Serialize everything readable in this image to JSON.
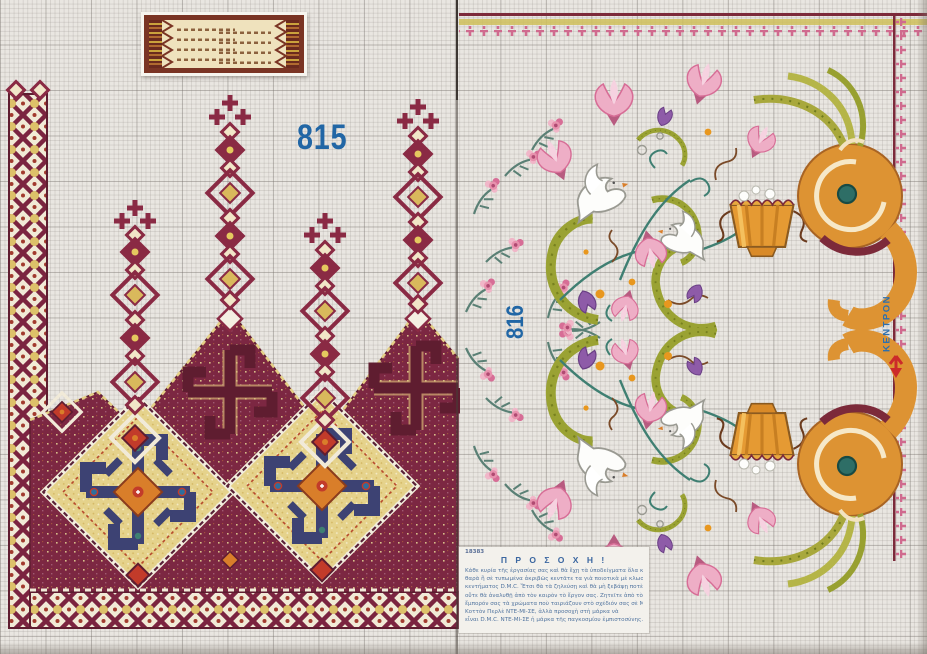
{
  "page": {
    "type_label": "cross-stitch pattern sheet",
    "left_pattern_number": "815",
    "right_pattern_number": "816",
    "kentron_label": "ΚΕΝΤΡΟΝ"
  },
  "caution": {
    "sheet_number": "18383",
    "title": "Π Ρ Ο Σ Ο Χ Η !",
    "lines": [
      "Κάθε κυρία τῆς ἐργασίας σας καὶ θὰ ἔχῃ τὰ ὑποδείγματα ὅλα κα-",
      "θαρὰ ἢ σὲ τυπωμένα ἀκριβῶς κεντᾶτε τα γιὰ ποιοτικὰ μὲ κλωστὲς",
      "κεντήματος D.M.C.  Ἔτσι θὰ τὰ ζηλεύσῃ καὶ θὰ μὴ ξεβάψῃ ποτὲ",
      "οὔτε θὰ ἀναλυθῇ ἀπὸ τὸν καιρὸν τὸ ἔργον σας.  Ζητεῖτε ἀπὸ τὸν",
      "ἔμπορόν σας τὰ χρώματα ποὺ ταιριάζουν στὸ σχέδιόν σας σὲ Μουλινὲ ἢ",
      "Κοττὸν Περλὲ ΝΤΕ-ΜΙ-ΣΕ,  ἀλλὰ προσοχὴ στὴ μάρκα νὰ",
      "εἶναι D.M.C.  ΝΤΕ-ΜΙ-ΣΕ ἡ μάρκα τῆς παγκοσμίου ἐμπιστοσύνης."
    ]
  },
  "icons": {
    "center_arrow": "red down-arrow marker",
    "dove": "white dove",
    "basket": "orange flower basket",
    "cornucopia": "orange spiral horn"
  },
  "colors": {
    "grid_paper": "#e9e6e1",
    "burgundy": "#7c2742",
    "maroon_dark": "#5f1d30",
    "yellow_ground": "#e5d28b",
    "navy_meander": "#3d4273",
    "orange": "#d97e2a",
    "red_accent": "#c23b2a",
    "olive_scroll": "#9aa233",
    "teal_stem": "#3f7f72",
    "pink_flower": "#e791ad",
    "purple_flower": "#8e5ba8",
    "label_blue": "#2166a5",
    "arrow_red": "#cc2a2a"
  }
}
